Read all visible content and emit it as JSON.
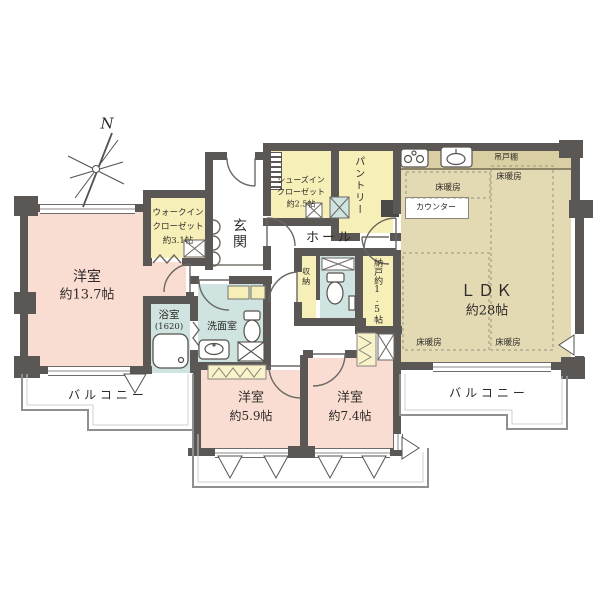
{
  "compass": {
    "north": "N"
  },
  "rooms": {
    "bedroom_main": {
      "name": "洋室",
      "size": "約13.7帖"
    },
    "wic": {
      "l1": "ウォークイン",
      "l2": "クローゼット",
      "l3": "約3.1帖"
    },
    "genkan": {
      "name": "玄関"
    },
    "sic": {
      "l1": "シューズイン",
      "l2": "クローゼット",
      "l3": "約2.5帖"
    },
    "pantry": {
      "name": "パントリー"
    },
    "hall": {
      "name": "ホール"
    },
    "ldk": {
      "name": "ＬＤＫ",
      "size": "約28帖"
    },
    "bath": {
      "name": "浴室",
      "size": "(1620)"
    },
    "washroom": {
      "name": "洗面室"
    },
    "storage": {
      "name": "収納"
    },
    "nando": {
      "name": "納戸約1.5帖"
    },
    "bedroom_59": {
      "name": "洋室",
      "size": "約5.9帖"
    },
    "bedroom_74": {
      "name": "洋室",
      "size": "約7.4帖"
    },
    "balcony": {
      "name": "バルコニー"
    }
  },
  "fixtures": {
    "hanging_cupboard": "吊戸棚",
    "counter": "カウンター",
    "floor_heating": "床暖房"
  },
  "colors": {
    "wall": "#5b5754",
    "bedroom": "#f9dcd2",
    "ldk": "#e3d9b3",
    "closet": "#f6efb8",
    "wet_area": "#cfe4e0",
    "balcony_outline": "#8f8f8f"
  }
}
